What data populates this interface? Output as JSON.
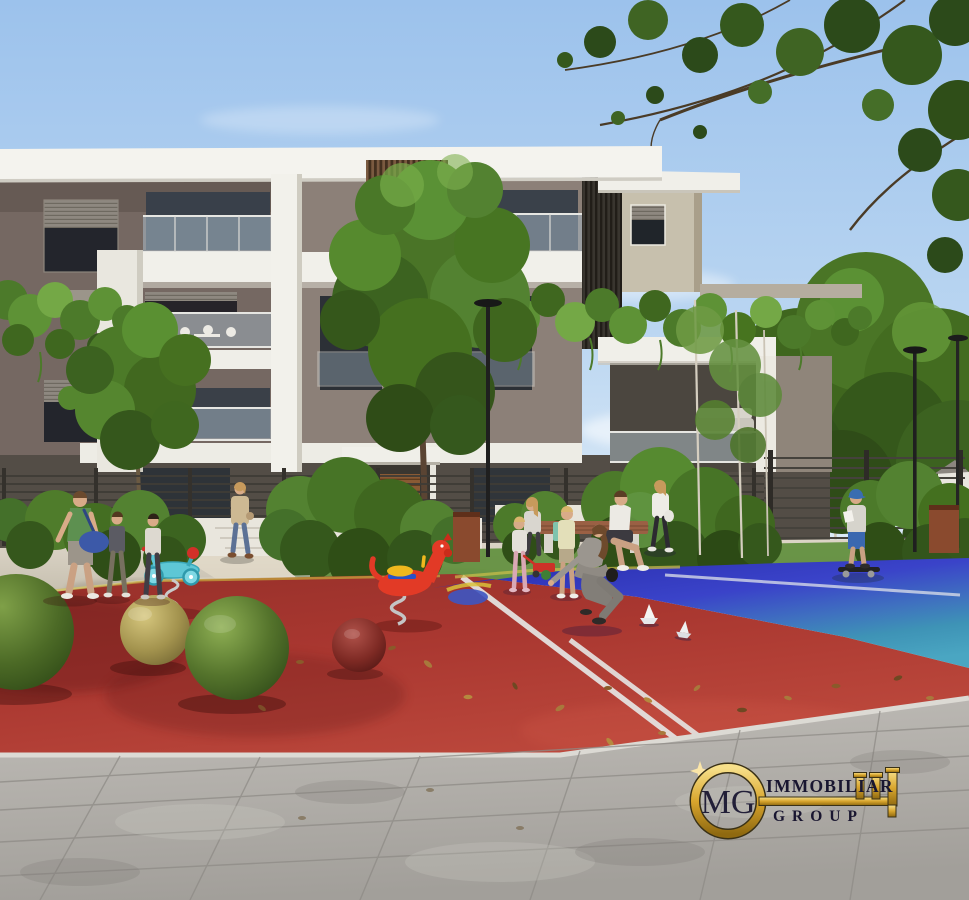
{
  "watermark": {
    "icon": "gold-key-icon",
    "monogram": "MG",
    "line1": "IMMOBILIAR",
    "line2": "GROUP",
    "gold": "#d9a62e",
    "text_color": "#191630"
  },
  "scene": {
    "palette": {
      "sky_top": "#a3c6ec",
      "sky_horizon": "#dcebf7",
      "foliage_dark": "#2f4e17",
      "foliage_mid": "#477426",
      "foliage_light": "#6aa03c",
      "building_wall_dark": "#756862",
      "building_wall_mid": "#8c8078",
      "building_wall_beige": "#c7c0ad",
      "building_trim_white": "#f1f0ea",
      "window_shutter": "#26242a",
      "wood_slats": "#7a5a40",
      "metal_fence": "#3f3c36",
      "walkway": "#d3ccbd",
      "court_red": "#b23a33",
      "court_blue": "#3a43c9",
      "court_teal": "#49a6c2",
      "court_line": "#e6e6e4",
      "ball_green": "#55742c",
      "ball_yellow": "#a3934e",
      "ball_red": "#7e2a24",
      "paving_gray": "#b0ada8",
      "corten_planter": "#8a4a2e",
      "spring_toy_red": "#e23a26",
      "spring_toy_teal": "#5ec7d6",
      "saddle_yellow": "#f0b81e"
    }
  }
}
